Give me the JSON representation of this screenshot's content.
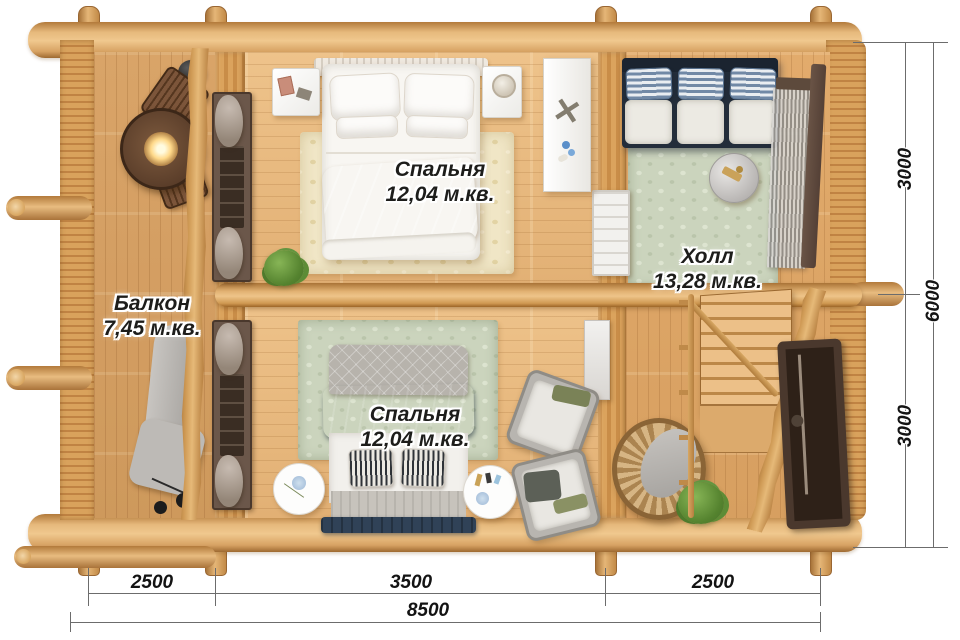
{
  "rooms": {
    "bedroom_top": {
      "name": "Спальня",
      "area": "12,04 м.кв."
    },
    "hall": {
      "name": "Холл",
      "area": "13,28 м.кв."
    },
    "balcony": {
      "name": "Балкон",
      "area": "7,45 м.кв."
    },
    "bedroom_bottom": {
      "name": "Спальня",
      "area": "12,04 м.кв."
    }
  },
  "dimensions": {
    "right_top": "3000",
    "right_bottom": "3000",
    "right_total": "6000",
    "bottom_left": "2500",
    "bottom_middle": "3500",
    "bottom_right": "2500",
    "bottom_total": "8500"
  },
  "icons": {
    "starfish": "✕"
  },
  "colors": {
    "wood_light": "#f0c88e",
    "wood_mid": "#d9a05f",
    "wood_dark": "#a06a31",
    "floor": "#e8bc82",
    "rug_cream": "#f0e6c6",
    "rug_sage": "#cbd4bd",
    "bed_white": "#f7f5f1",
    "bed_navy": "#33506a",
    "sofa_navy": "#232d3a",
    "curtain_taupe": "#a89b8f",
    "frame_brown": "#4a382c",
    "dimension_line": "#6c6c6c",
    "label_text": "#1d1d1b"
  }
}
